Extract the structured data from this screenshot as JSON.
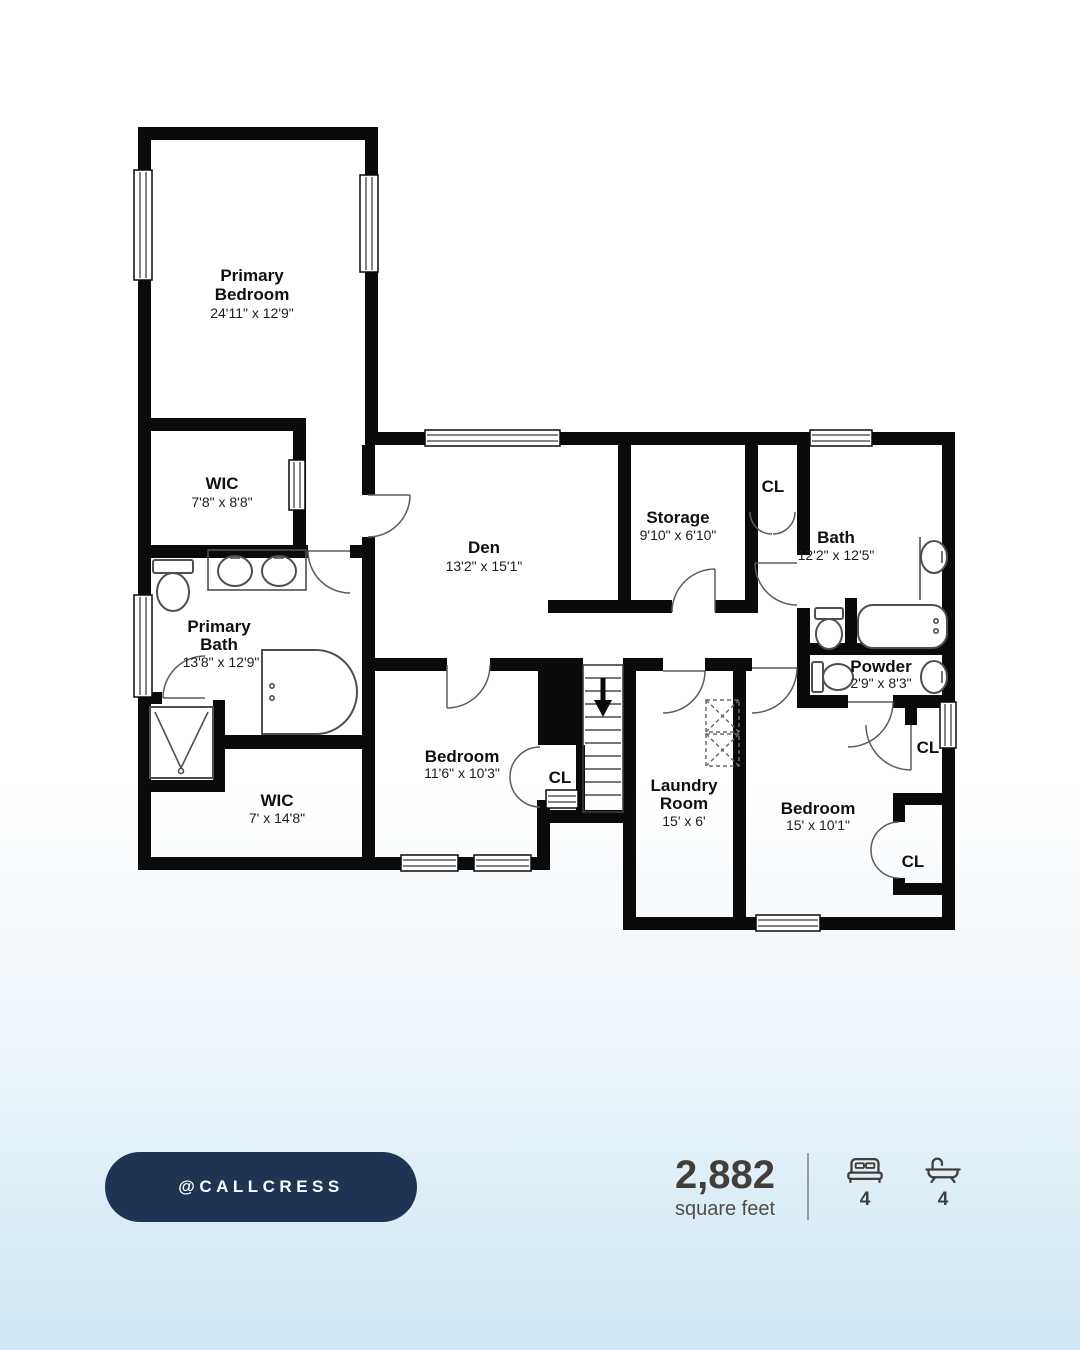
{
  "plan": {
    "rooms": {
      "primary_bedroom": {
        "name1": "Primary",
        "name2": "Bedroom",
        "dims": "24'11\" x 12'9\""
      },
      "wic_upper": {
        "name1": "WIC",
        "dims": "7'8\" x 8'8\""
      },
      "primary_bath": {
        "name1": "Primary",
        "name2": "Bath",
        "dims": "13'8\" x 12'9\""
      },
      "wic_lower": {
        "name1": "WIC",
        "dims": "7' x 14'8\""
      },
      "den": {
        "name1": "Den",
        "dims": "13'2\" x 15'1\""
      },
      "storage": {
        "name1": "Storage",
        "dims": "9'10\" x 6'10\""
      },
      "bath": {
        "name1": "Bath",
        "dims": "12'2\" x 12'5\""
      },
      "powder": {
        "name1": "Powder",
        "dims": "2'9\" x 8'3\""
      },
      "bedroom_center": {
        "name1": "Bedroom",
        "dims": "11'6\" x 10'3\""
      },
      "laundry": {
        "name1": "Laundry",
        "name2": "Room",
        "dims": "15' x 6'"
      },
      "bedroom_right": {
        "name1": "Bedroom",
        "dims": "15' x 10'1\""
      }
    },
    "closet_label": "CL"
  },
  "footer": {
    "handle": "@CALLCRESS",
    "sqft_value": "2,882",
    "sqft_label": "square feet",
    "beds": "4",
    "baths": "4"
  },
  "colors": {
    "pill_background": "#1e3452",
    "wall": "#0a0a0a",
    "footer_text": "#443e3a",
    "background_bottom": "#cfe6f3"
  }
}
